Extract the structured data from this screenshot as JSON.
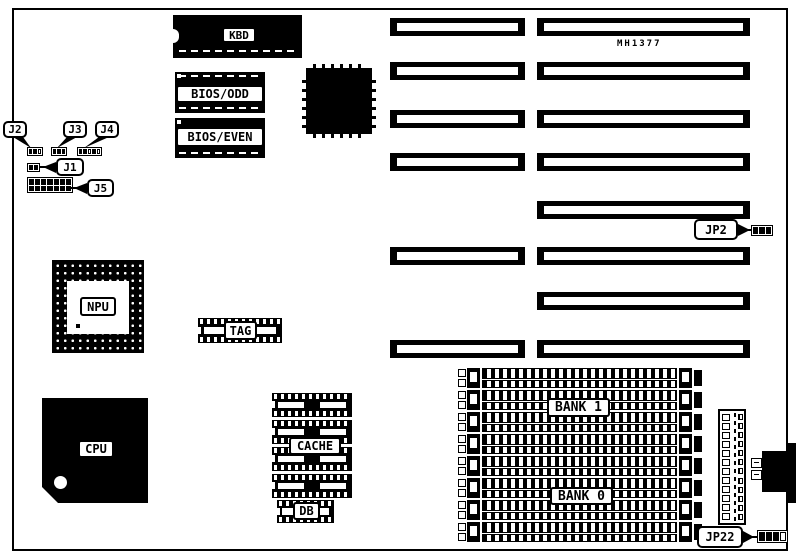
{
  "diagram": {
    "part_number": "MH1377",
    "labels": {
      "kbd": "KBD",
      "bios_odd": "BIOS/ODD",
      "bios_even": "BIOS/EVEN",
      "npu": "NPU",
      "cpu": "CPU",
      "tag": "TAG",
      "cache": "CACHE",
      "db": "DB",
      "bank1": "BANK 1",
      "bank0": "BANK 0"
    },
    "jumpers": {
      "j1": "J1",
      "j2": "J2",
      "j3": "J3",
      "j4": "J4",
      "j5": "J5",
      "jp2": "JP2",
      "jp22": "JP22"
    },
    "colors": {
      "ink": "#000000",
      "paper": "#ffffff"
    }
  }
}
